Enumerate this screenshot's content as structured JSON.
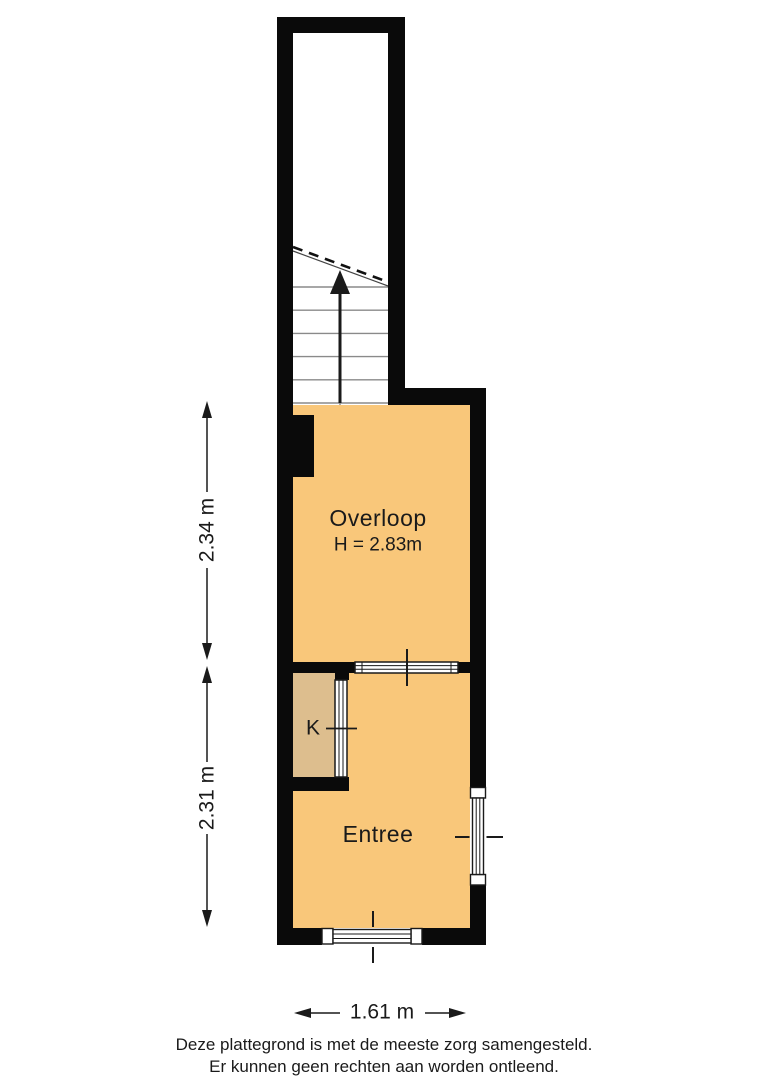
{
  "rooms": {
    "overloop": {
      "label": "Overloop",
      "height": "H = 2.83m"
    },
    "entree": {
      "label": "Entree"
    },
    "closet": {
      "label": "K"
    }
  },
  "dimensions": {
    "upper_vertical": "2.34 m",
    "lower_vertical": "2.31 m",
    "bottom_horizontal": "1.61 m"
  },
  "disclaimer": {
    "line1": "Deze plattegrond is met de meeste zorg samengesteld.",
    "line2": "Er kunnen geen rechten aan worden ontleend."
  },
  "colors": {
    "wall": "#0a0a0a",
    "floor": "#F9C77A",
    "closet_floor": "#DDBE8E",
    "stair_line": "#8a8a8a"
  }
}
